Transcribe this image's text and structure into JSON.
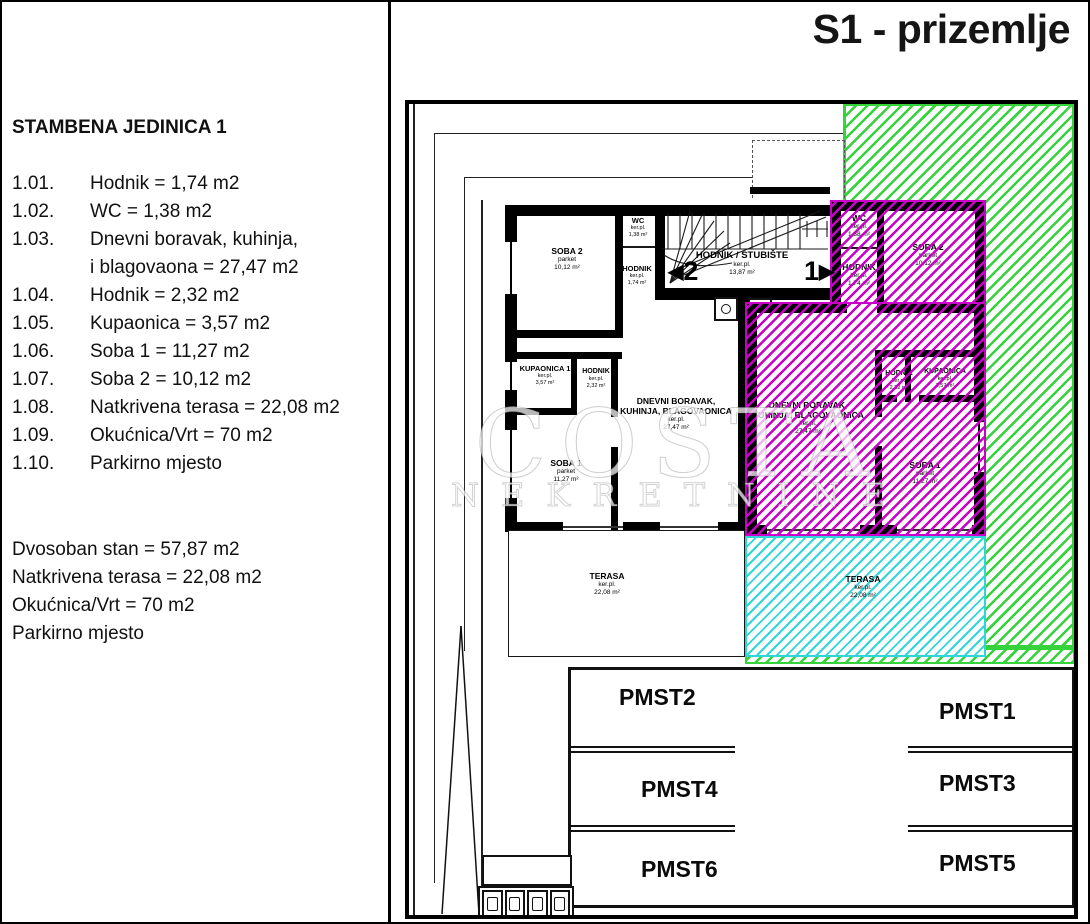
{
  "title": "S1 - prizemlje",
  "sidebar": {
    "heading": "STAMBENA JEDINICA 1",
    "items": [
      {
        "num": "1.01.",
        "text": "Hodnik = 1,74 m2"
      },
      {
        "num": "1.02.",
        "text": "WC = 1,38 m2"
      },
      {
        "num": "1.03.",
        "text": "Dnevni boravak, kuhinja,"
      },
      {
        "num": "",
        "text": "i blagovaona = 27,47 m2"
      },
      {
        "num": "1.04.",
        "text": "Hodnik = 2,32 m2"
      },
      {
        "num": "1.05.",
        "text": "Kupaonica = 3,57 m2"
      },
      {
        "num": "1.06.",
        "text": "Soba 1 = 11,27 m2"
      },
      {
        "num": "1.07.",
        "text": "Soba 2 = 10,12 m2"
      },
      {
        "num": "1.08.",
        "text": "Natkrivena terasa = 22,08 m2"
      },
      {
        "num": "1.09.",
        "text": "Okućnica/Vrt = 70 m2"
      },
      {
        "num": "1.10.",
        "text": "Parkirno mjesto"
      }
    ],
    "summary": [
      "Dvosoban stan = 57,87 m2",
      "Natkrivena terasa = 22,08 m2",
      "Okućnica/Vrt = 70 m2",
      "Parkirno mjesto"
    ]
  },
  "plan": {
    "watermark": {
      "line1": "COSTA",
      "line2": "NEKRETNINE"
    },
    "stair_hall": {
      "name": "HODNIK / STUBIŠTE",
      "floor": "ker.pl.",
      "area": "13,87 m²"
    },
    "unit_markers": {
      "left_arrow": "◀",
      "left_num": "2",
      "right_num": "1",
      "right_arrow": "▶"
    },
    "left_unit": {
      "soba2": {
        "name": "SOBA 2",
        "floor": "parket",
        "area": "10,12 m²"
      },
      "wc": {
        "name": "WC",
        "floor": "ker.pl.",
        "area": "1,38 m²"
      },
      "hodnik1": {
        "name": "HODNIK",
        "floor": "ker.pl.",
        "area": "1,74 m²"
      },
      "kupaonica": {
        "name": "KUPAONICA 1",
        "floor": "ker.pl.",
        "area": "3,57 m²"
      },
      "hodnik2": {
        "name": "HODNIK",
        "floor": "ker.pl.",
        "area": "2,32 m²"
      },
      "dnevni": {
        "name": "DNEVNI BORAVAK,",
        "name2": "KUHINJA, BLAGOVAONICA",
        "floor": "ker.pl.",
        "area": "27,47 m²"
      },
      "soba1": {
        "name": "SOBA 1",
        "floor": "parket",
        "area": "11,27 m²"
      },
      "terasa": {
        "name": "TERASA",
        "floor": "ker.pl.",
        "area": "22,08 m²"
      }
    },
    "right_unit": {
      "wc": {
        "name": "WC",
        "floor": "ker.pl.",
        "area": "1,38 m²"
      },
      "hodnik1": {
        "name": "HODNIK",
        "floor": "ker.pl.",
        "area": "1,74 m²"
      },
      "soba2": {
        "name": "SOBA 2",
        "floor": "parket",
        "area": "10,12 m²"
      },
      "hodnik2": {
        "name": "HODNIK",
        "floor": "ker.pl.",
        "area": "2,32 m²"
      },
      "kupaonica": {
        "name": "KUPAONICA",
        "floor": "ker.pl.",
        "area": "3,57 m²"
      },
      "dnevni": {
        "name": "DNEVNI BORAVAK,",
        "name2": "KUHINJA, BLAGOVAONICA",
        "floor": "ker.pl.",
        "area": "27,47 m²"
      },
      "soba1": {
        "name": "SOBA 1",
        "floor": "parket",
        "area": "11,27 m²"
      },
      "terasa": {
        "name": "TERASA",
        "floor": "ker.pl.",
        "area": "22,08 m²"
      }
    },
    "colors": {
      "okucnica_green": "#35d23c",
      "unit_magenta": "#c800c8",
      "terasa_cyan": "#2fd5d8"
    }
  },
  "parking": {
    "rows": [
      [
        "PMST2",
        "PMST1"
      ],
      [
        "PMST4",
        "PMST3"
      ],
      [
        "PMST6",
        "PMST5"
      ]
    ]
  }
}
